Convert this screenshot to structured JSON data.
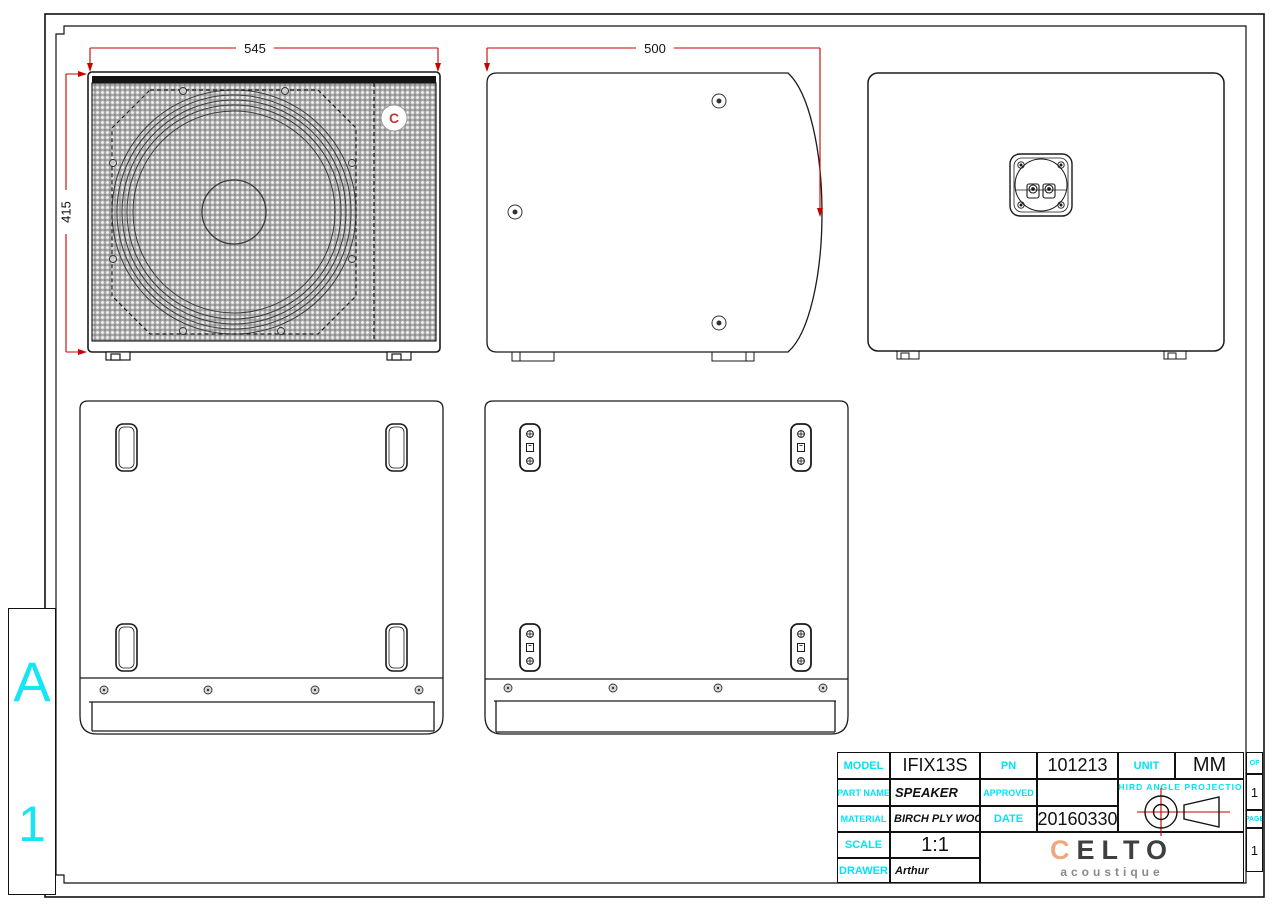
{
  "zone_panel": {
    "letter": "A",
    "number": "1"
  },
  "dimensions": {
    "front_width": "545",
    "front_height": "415",
    "side_depth": "500"
  },
  "front_view": {
    "logo_letter": "C"
  },
  "title_block": {
    "model_label": "MODEL",
    "model_value": "IFIX13S",
    "pn_label": "PN",
    "pn_value": "101213",
    "unit_label": "UNIT",
    "unit_value": "MM",
    "part_name_label": "PART NAME",
    "part_name_value": "SPEAKER",
    "approved_label": "APPROVED",
    "approved_value": "",
    "material_label": "MATERIAL",
    "material_value": "BIRCH  PLY WOOD",
    "date_label": "DATE",
    "date_value": "20160330",
    "scale_label": "SCALE",
    "scale_value": "1:1",
    "drawer_label": "DRAWER",
    "drawer_value": "Arthur",
    "projection_label": "THIRD  ANGLE  PROJECTION",
    "sheet_of_label": "OF",
    "sheet_of_value": "1",
    "sheet_page_label": "PAGE",
    "sheet_page_value": "1",
    "logo_c": "C",
    "logo_rest": "ELTO",
    "logo_sub": "acoustique"
  },
  "colors": {
    "dimension_red": "#c90000",
    "label_cyan": "#00e4f6",
    "logo_orange": "#f0a87c"
  }
}
